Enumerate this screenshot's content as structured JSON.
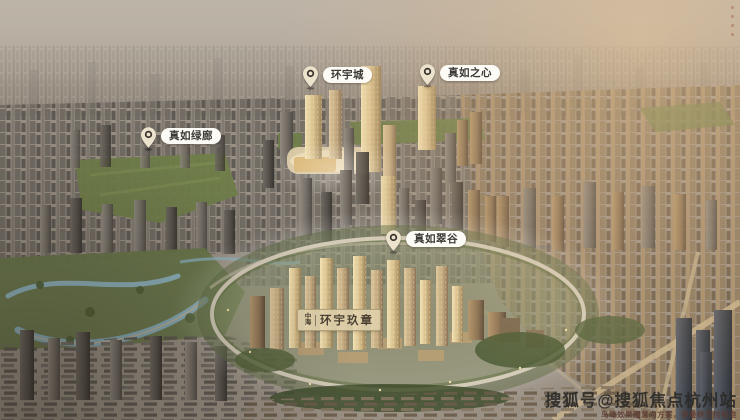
{
  "markers": [
    {
      "label": "真如绿廊"
    },
    {
      "label": "环宇城"
    },
    {
      "label": "真如之心"
    },
    {
      "label": "真如翠谷"
    }
  ],
  "plaque": {
    "prefix": "中海",
    "title": "环宇玖章"
  },
  "watermark": {
    "main": "搜狐号@搜狐焦点杭州站",
    "sub": "鸟瞰效果图意向方案，非最终交付标准"
  },
  "colors": {
    "pill_bg": "#fdfbf5",
    "pill_text": "#3c3a36",
    "pin_fill": "#ece3cc",
    "pin_ring": "#35302a",
    "plaque_bg": "rgba(224,209,172,0.88)",
    "plaque_text": "#4a4031",
    "watermark_main": "#2b2a28",
    "watermark_sub": "#5c3a31",
    "gold_light": "#f1e0b2",
    "green_park": "#70804a",
    "water": "#8aadb9"
  }
}
